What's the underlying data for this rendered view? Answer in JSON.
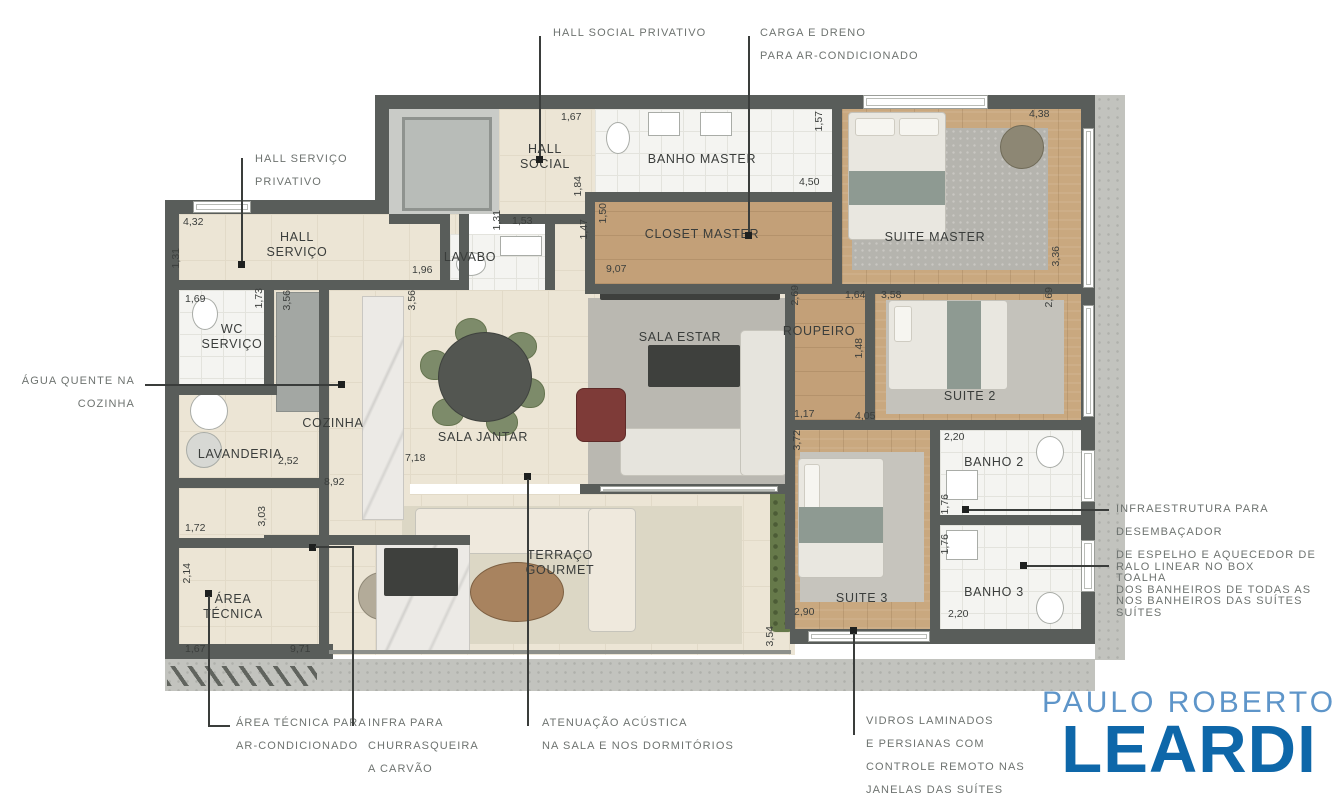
{
  "logo": {
    "line1": "PAULO ROBERTO",
    "line2": "LEARDI",
    "color_light": "#5E95C9",
    "color_dark": "#0E67A9"
  },
  "rooms": {
    "hall_social": {
      "label": "HALL\nSOCIAL"
    },
    "banho_master": {
      "label": "BANHO MASTER"
    },
    "suite_master": {
      "label": "SUITE MASTER"
    },
    "closet_master": {
      "label": "CLOSET MASTER"
    },
    "hall_servico": {
      "label": "HALL\nSERVIÇO"
    },
    "lavabo": {
      "label": "LAVABO"
    },
    "wc_servico": {
      "label": "WC\nSERVIÇO"
    },
    "cozinha": {
      "label": "COZINHA"
    },
    "sala_jantar": {
      "label": "SALA JANTAR"
    },
    "sala_estar": {
      "label": "SALA ESTAR"
    },
    "roupeiro": {
      "label": "ROUPEIRO"
    },
    "suite_2": {
      "label": "SUITE 2"
    },
    "lavanderia": {
      "label": "LAVANDERIA"
    },
    "banho_2": {
      "label": "BANHO 2"
    },
    "terraco": {
      "label": "TERRAÇO\nGOURMET"
    },
    "suite_3": {
      "label": "SUITE 3"
    },
    "banho_3": {
      "label": "BANHO 3"
    },
    "area_tecnica": {
      "label": "ÁREA\nTÉCNICA"
    }
  },
  "annotations": {
    "hall_social_privativo": {
      "lines": [
        "HALL SOCIAL PRIVATIVO"
      ]
    },
    "carga_dreno": {
      "lines": [
        "CARGA E DRENO",
        "PARA AR-CONDICIONADO"
      ]
    },
    "hall_servico_privativo": {
      "lines": [
        "HALL SERVIÇO",
        "PRIVATIVO"
      ]
    },
    "agua_quente": {
      "lines": [
        "ÁGUA QUENTE NA",
        "COZINHA"
      ]
    },
    "area_tecnica_ar": {
      "lines": [
        "ÁREA TÉCNICA PARA",
        "AR-CONDICIONADO"
      ]
    },
    "infra_churrasqueira": {
      "lines": [
        "INFRA PARA",
        "CHURRASQUEIRA",
        "A CARVÃO"
      ]
    },
    "atenuacao_acustica": {
      "lines": [
        "ATENUAÇÃO ACÚSTICA",
        "NA SALA E NOS DORMITÓRIOS"
      ]
    },
    "vidros_laminados": {
      "lines": [
        "VIDROS LAMINADOS",
        "E PERSIANAS COM",
        "CONTROLE REMOTO NAS",
        "JANELAS DAS SUÍTES"
      ]
    },
    "infraestrutura_desembacador": {
      "lines": [
        "INFRAESTRUTURA PARA DESEMBAÇADOR",
        "DE ESPELHO E AQUECEDOR DE TOALHA",
        "NOS BANHEIROS DAS SUÍTES"
      ]
    },
    "ralo_linear": {
      "lines": [
        "RALO LINEAR NO BOX",
        "DOS BANHEIROS DE TODAS AS SUÍTES"
      ]
    }
  },
  "dimensions": [
    {
      "v": "4,32",
      "x": 183,
      "y": 216
    },
    {
      "v": "1,31",
      "x": 170,
      "y": 248,
      "r": 1
    },
    {
      "v": "1,69",
      "x": 185,
      "y": 293
    },
    {
      "v": "1,73",
      "x": 253,
      "y": 288,
      "r": 1
    },
    {
      "v": "3,56",
      "x": 281,
      "y": 290,
      "r": 1
    },
    {
      "v": "3,56",
      "x": 406,
      "y": 290,
      "r": 1
    },
    {
      "v": "1,96",
      "x": 412,
      "y": 264
    },
    {
      "v": "1,31",
      "x": 491,
      "y": 210,
      "r": 1
    },
    {
      "v": "1,53",
      "x": 512,
      "y": 215
    },
    {
      "v": "1,67",
      "x": 561,
      "y": 111
    },
    {
      "v": "1,84",
      "x": 572,
      "y": 176,
      "r": 1
    },
    {
      "v": "1,50",
      "x": 597,
      "y": 203,
      "r": 1
    },
    {
      "v": "1,47",
      "x": 578,
      "y": 219,
      "r": 1
    },
    {
      "v": "9,07",
      "x": 606,
      "y": 263
    },
    {
      "v": "4,50",
      "x": 799,
      "y": 176
    },
    {
      "v": "1,57",
      "x": 813,
      "y": 111,
      "r": 1
    },
    {
      "v": "4,38",
      "x": 1029,
      "y": 108
    },
    {
      "v": "3,36",
      "x": 1050,
      "y": 246,
      "r": 1
    },
    {
      "v": "2,69",
      "x": 1043,
      "y": 287,
      "r": 1
    },
    {
      "v": "2,69",
      "x": 789,
      "y": 285,
      "r": 1
    },
    {
      "v": "1,64",
      "x": 845,
      "y": 289
    },
    {
      "v": "3,58",
      "x": 881,
      "y": 289
    },
    {
      "v": "1,48",
      "x": 853,
      "y": 338,
      "r": 1
    },
    {
      "v": "1,17",
      "x": 794,
      "y": 408
    },
    {
      "v": "4,05",
      "x": 855,
      "y": 410
    },
    {
      "v": "3,72",
      "x": 791,
      "y": 430,
      "r": 1
    },
    {
      "v": "2,20",
      "x": 944,
      "y": 431
    },
    {
      "v": "1,76",
      "x": 939,
      "y": 494,
      "r": 1
    },
    {
      "v": "1,76",
      "x": 939,
      "y": 534,
      "r": 1
    },
    {
      "v": "2,20",
      "x": 948,
      "y": 608
    },
    {
      "v": "2,90",
      "x": 794,
      "y": 606
    },
    {
      "v": "3,54",
      "x": 764,
      "y": 626,
      "r": 1
    },
    {
      "v": "2,52",
      "x": 278,
      "y": 455
    },
    {
      "v": "8,92",
      "x": 324,
      "y": 476
    },
    {
      "v": "7,18",
      "x": 405,
      "y": 452
    },
    {
      "v": "1,72",
      "x": 185,
      "y": 522
    },
    {
      "v": "3,03",
      "x": 256,
      "y": 506,
      "r": 1
    },
    {
      "v": "2,14",
      "x": 181,
      "y": 563,
      "r": 1
    },
    {
      "v": "1,67",
      "x": 185,
      "y": 643
    },
    {
      "v": "9,71",
      "x": 290,
      "y": 643
    }
  ]
}
